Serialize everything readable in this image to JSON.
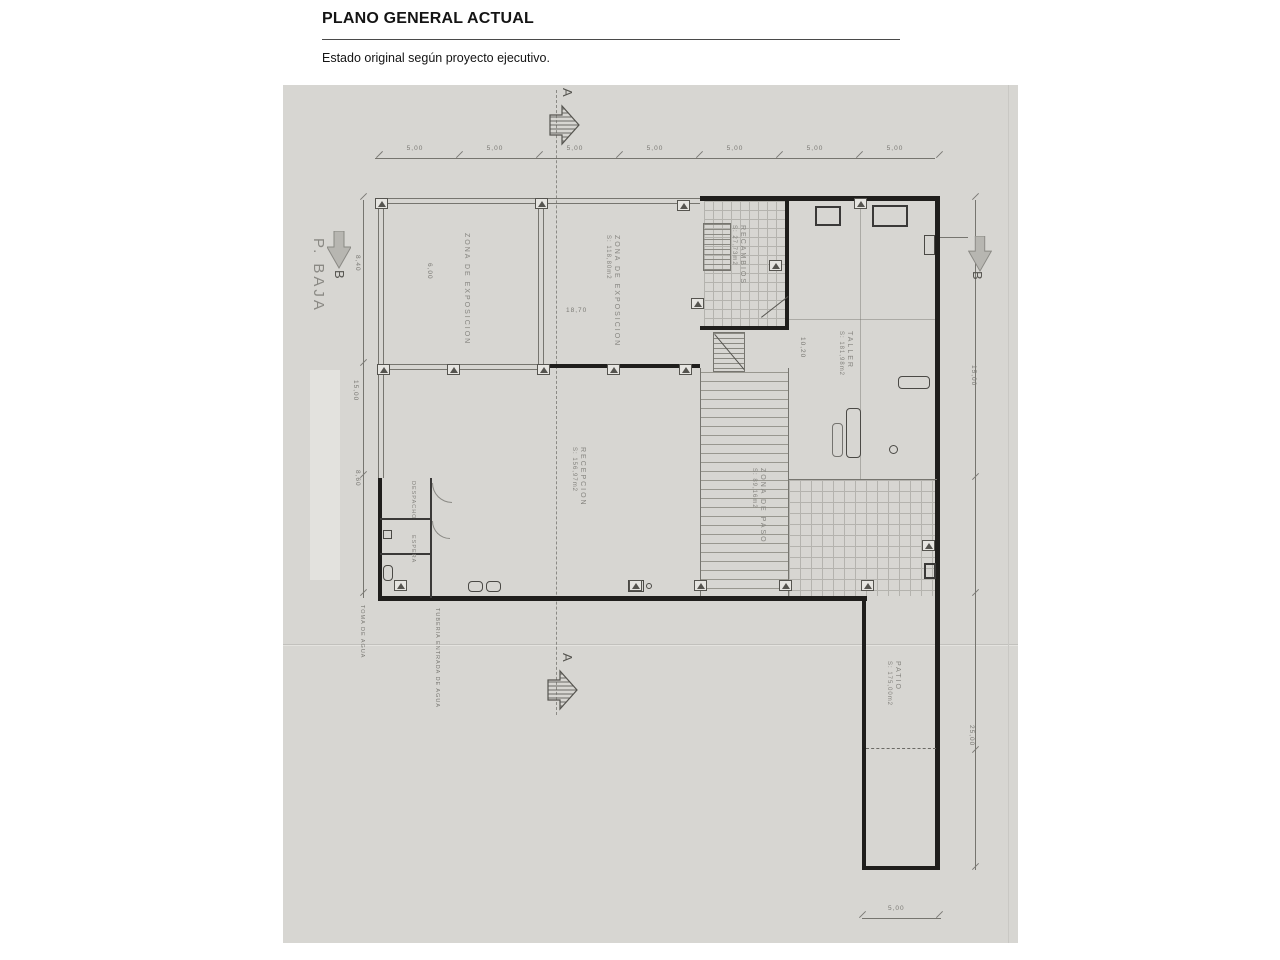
{
  "header": {
    "title": "PLANO GENERAL ACTUAL",
    "subtitle": "Estado original según proyecto ejecutivo."
  },
  "markers": {
    "a_top": "A",
    "a_bottom": "A",
    "b_left": "B",
    "b_right": "B",
    "floor": "P. BAJA"
  },
  "dims": {
    "top": [
      "5,00",
      "5,00",
      "5,00",
      "5,00",
      "5,00",
      "5,00",
      "5,00"
    ],
    "left_8_40": "8,40",
    "left_15_00": "15,00",
    "left_8_60": "8,60",
    "right_15_00": "15,00",
    "right_25_00": "25,00",
    "bottom_5_00": "5,00",
    "interior_18_70": "18,70",
    "interior_10_20": "10,20",
    "interior_6_00": "6,00"
  },
  "rooms": {
    "exposicion_left": {
      "name": "ZONA DE EXPOSICION"
    },
    "exposicion_right": {
      "name": "ZONA DE EXPOSICION",
      "area": "S: 118,80m2"
    },
    "recambios": {
      "name": "RECAMBIOS",
      "area": "S: 27,73m2"
    },
    "taller": {
      "name": "TALLER",
      "area": "S: 181,98m2"
    },
    "recepcion": {
      "name": "RECEPCION",
      "area": "S: 156,97m2"
    },
    "paso": {
      "name": "ZONA DE PASO",
      "area": "S: 89,16m2"
    },
    "patio": {
      "name": "PATIO",
      "area": "S: 175,00m2"
    },
    "despacho": {
      "name": "DESPACHO"
    },
    "espera": {
      "name": "ESPERA"
    }
  },
  "annotations": {
    "toma_agua": "TOMA DE AGUA",
    "tuberia": "TUBERIA ENTRADA DE AGUA"
  },
  "colors": {
    "scan_bg": "#d7d6d2",
    "wall": "#1f1e1c",
    "line": "#76756f",
    "label": "#84837e",
    "arrow_fill": "#b7b6b1"
  }
}
